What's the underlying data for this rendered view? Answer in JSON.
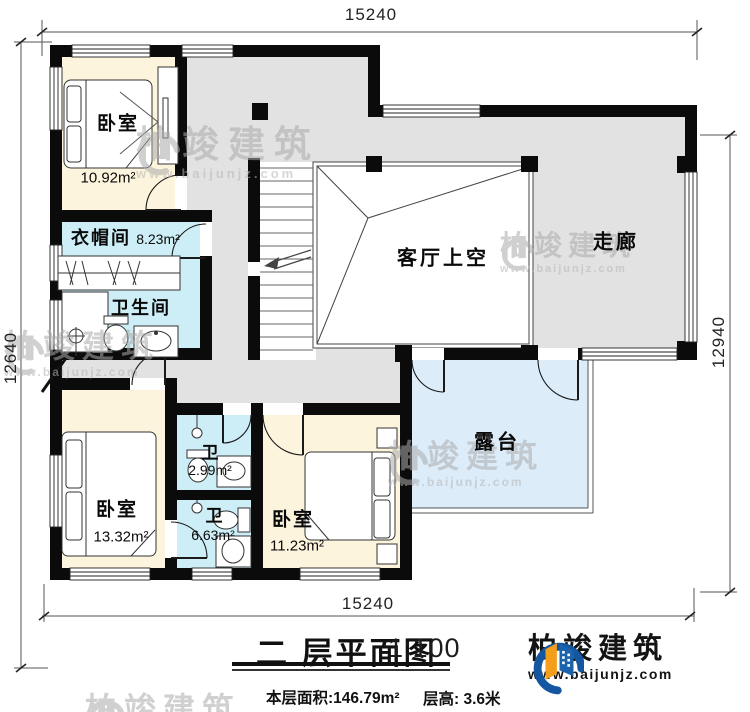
{
  "dimensions": {
    "top": "15240",
    "bottom": "15240",
    "left": "12640",
    "right": "12940"
  },
  "rooms": {
    "bedroom_top": {
      "name": "卧室",
      "area": "10.92m²"
    },
    "cloakroom": {
      "name": "衣帽间",
      "area": "8.23m²"
    },
    "bathroom_main": {
      "name": "卫生间"
    },
    "living_room_void": {
      "name": "客厅上空"
    },
    "corridor": {
      "name": "走廊"
    },
    "terrace": {
      "name": "露台"
    },
    "bedroom_left": {
      "name": "卧室",
      "area": "13.32m²"
    },
    "bathroom_small": {
      "name": "卫",
      "area": "2.99m²"
    },
    "bathroom_ensuite": {
      "name": "卫",
      "area": "6.63m²"
    },
    "bedroom_right": {
      "name": "卧室",
      "area": "11.23m²"
    }
  },
  "title_block": {
    "title": "二 层平面图",
    "scale": "1:100",
    "floor_area": "本层面积:146.79m²",
    "floor_height": "层高: 3.6米"
  },
  "brand": {
    "name": "柏竣建筑",
    "url": "www.baijunjz.com"
  },
  "watermark": {
    "name": "柏竣建筑",
    "url": "www.baijunjz.com"
  },
  "colors": {
    "wall": "#0b0b0b",
    "bedroom_fill": "#fcf4dd",
    "wet_room_fill": "#cdeef6",
    "hall_fill": "#e2e2e2",
    "terrace_fill": "#dcecf9",
    "brand_blue": "#1a5da6",
    "brand_orange": "#f59e1b"
  }
}
